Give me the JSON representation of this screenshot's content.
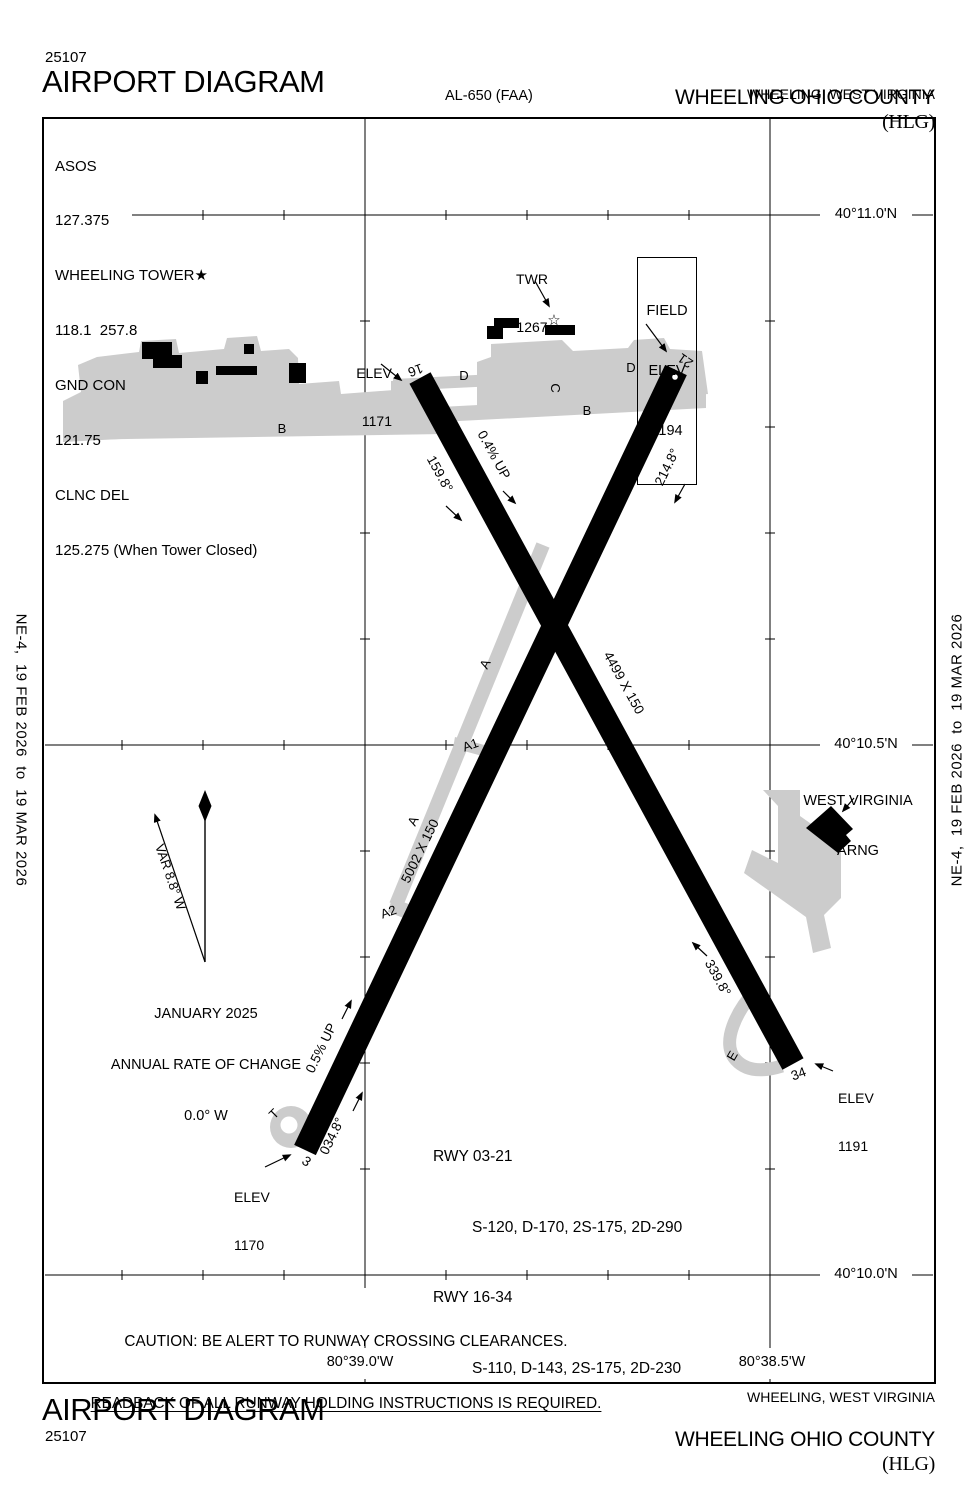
{
  "header": {
    "chart_code": "25107",
    "title": "AIRPORT DIAGRAM",
    "procedure_id": "AL-650 (FAA)",
    "airport_name": "WHEELING OHIO COUNTY",
    "airport_icao": "(HLG)",
    "city": "WHEELING, WEST VIRGINIA"
  },
  "margin_note": "NE-4,  19 FEB 2026  to  19 MAR 2026",
  "comm": {
    "asos_label": "ASOS",
    "asos_freq": "127.375",
    "twr_label": "WHEELING TOWER★",
    "twr_freq": "118.1  257.8",
    "gnd_label": "GND CON",
    "gnd_freq": "121.75",
    "clnc_label": "CLNC DEL",
    "clnc_freq": "125.275 (When Tower Closed)"
  },
  "tower": {
    "label": "TWR",
    "elev": "1267",
    "star": "☆"
  },
  "field_elev": {
    "l1": "FIELD",
    "l2": "ELEV",
    "l3": "1194"
  },
  "graticule": {
    "lat1": "40°11.0'N",
    "lat2": "40°10.5'N",
    "lat3": "40°10.0'N",
    "lon1": "80°39.0'W",
    "lon2": "80°38.5'W"
  },
  "compass": {
    "variation": "VAR 8.8° W",
    "date": "JANUARY 2025",
    "rate_label": "ANNUAL RATE OF CHANGE",
    "rate_value": "0.0° W"
  },
  "runway_16_34": {
    "num16": "16",
    "num34": "34",
    "hdg16": "159.8°",
    "hdg34": "339.8°",
    "dim": "4499 X 150",
    "slope": "0.4% UP",
    "elev16_label": "ELEV",
    "elev16": "1171",
    "elev34_label": "ELEV",
    "elev34": "1191"
  },
  "runway_03_21": {
    "num3": "3",
    "num21": "21",
    "hdg3": "034.8°",
    "hdg21": "214.8°",
    "dim": "5002 X 150",
    "slope": "0.5% UP",
    "elev3_label": "ELEV",
    "elev3": "1170"
  },
  "taxiways": {
    "a": "A",
    "a1": "A1",
    "a2": "A2",
    "b": "B",
    "c": "C",
    "d": "D",
    "e": "E",
    "t": "T"
  },
  "arng": {
    "l1": "WEST VIRGINIA",
    "l2": "ARNG"
  },
  "rwy_data": {
    "r1_name": "RWY 03-21",
    "r1_val": "S-120, D-170, 2S-175, 2D-290",
    "r2_name": "RWY 16-34",
    "r2_val": "S-110, D-143, 2S-175, 2D-230"
  },
  "caution": {
    "l1": "CAUTION: BE ALERT TO RUNWAY CROSSING CLEARANCES.",
    "l2": "READBACK OF ALL RUNWAY HOLDING INSTRUCTIONS IS REQUIRED."
  }
}
